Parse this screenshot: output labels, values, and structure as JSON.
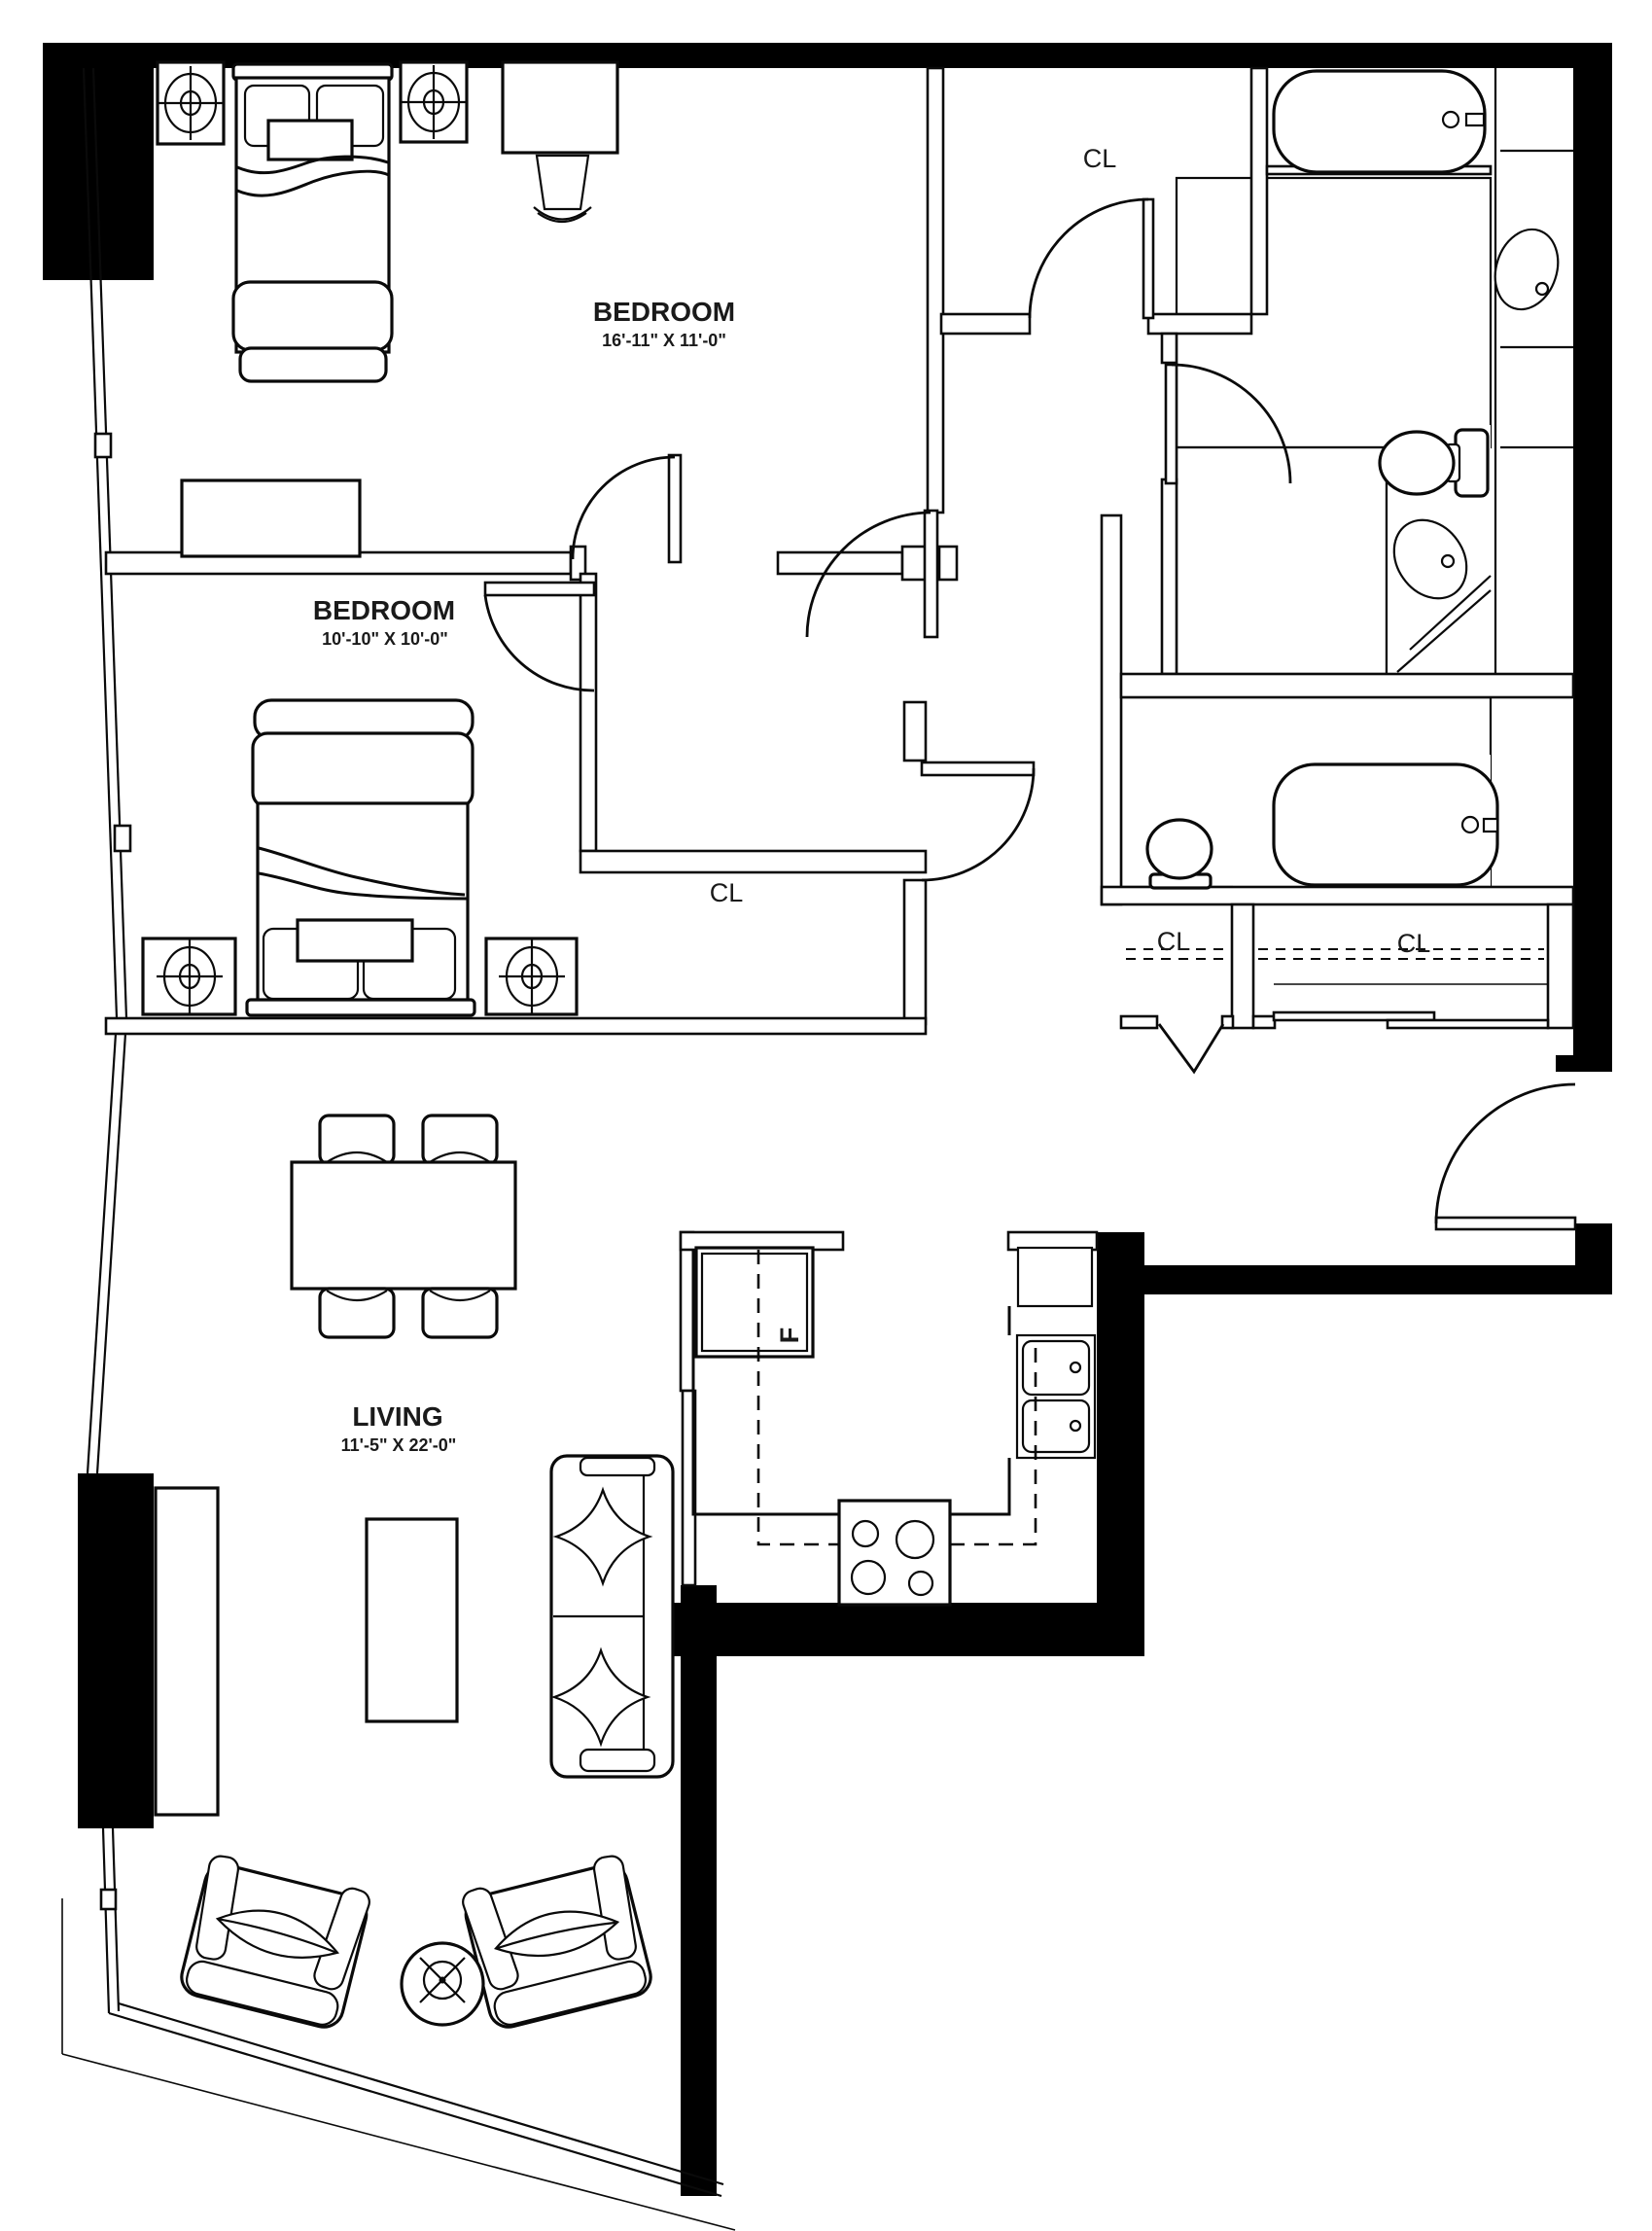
{
  "plan": {
    "type": "apartment-floor-plan",
    "rooms": {
      "bedroom1": {
        "name": "BEDROOM",
        "dims": "16'-11\" X 11'-0\""
      },
      "bedroom2": {
        "name": "BEDROOM",
        "dims": "10'-10\" X 10'-0\""
      },
      "living": {
        "name": "LIVING",
        "dims": "11'-5\" X 22'-0\""
      }
    },
    "closets": {
      "top": "CL",
      "middle": "CL",
      "entry_small": "CL",
      "entry_large": "CL"
    },
    "kitchen": {
      "fridge": "F"
    },
    "colors": {
      "walls": "#000000",
      "lines": "#0a0a0a",
      "background": "#ffffff"
    }
  }
}
